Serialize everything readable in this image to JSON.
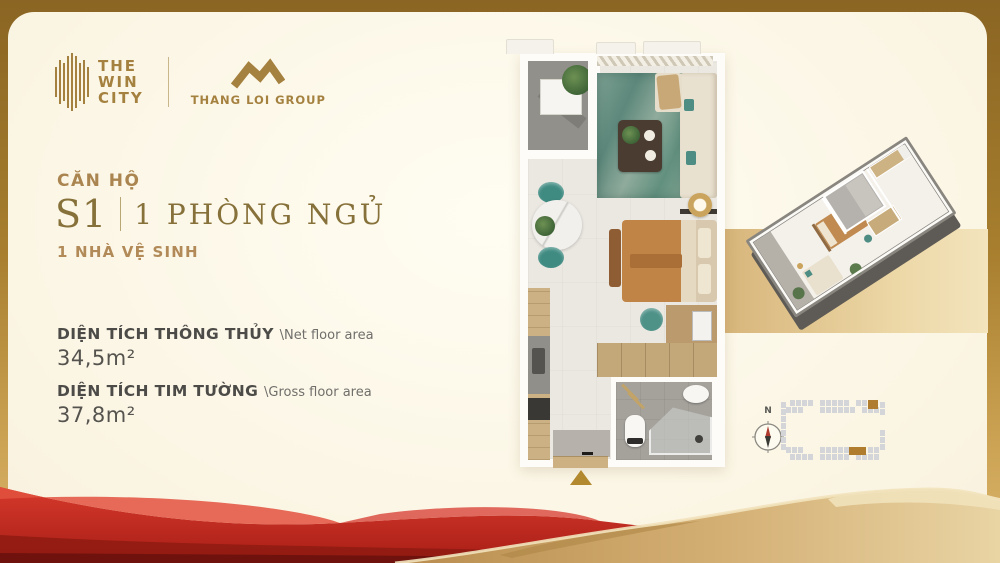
{
  "brand": {
    "win_city_lines": [
      "THE",
      "WIN",
      "CITY"
    ],
    "group_name": "THANG LOI GROUP"
  },
  "unit": {
    "label": "CĂN HỘ",
    "code": "S1",
    "type": "1 PHÒNG NGỦ",
    "bath": "1 NHÀ VỆ SINH"
  },
  "areas": {
    "net_label": "DIỆN TÍCH THÔNG THỦY",
    "net_sublabel": "\\Net floor area",
    "net_value": "34,5m²",
    "gross_label": "DIỆN TÍCH TIM TƯỜNG",
    "gross_sublabel": "\\Gross floor area",
    "gross_value": "37,8m²"
  },
  "compass": {
    "north_label": "N"
  },
  "colors": {
    "brand_gold": "#a5813f",
    "title_serif": "#87713a",
    "text_dark": "#4c4b48",
    "unit_highlight": "#b3892f",
    "siteplan_cell": "#d3d5d8",
    "siteplan_highlight": "#b07d2e",
    "accent_teal": "#4e8d84",
    "ribbon_red": "#c4281f",
    "ribbon_gold": "#cfa866"
  }
}
